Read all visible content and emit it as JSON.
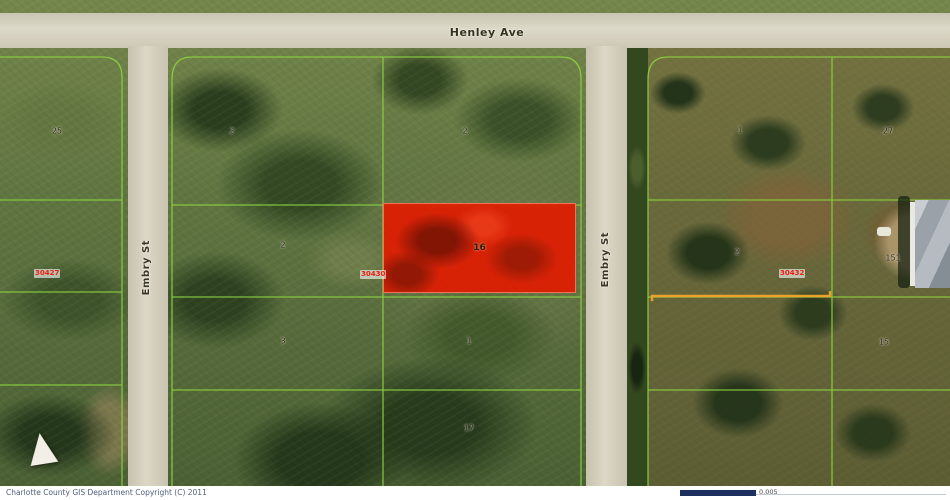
{
  "map": {
    "streets": {
      "top": {
        "label": "Henley Ave"
      },
      "left": {
        "label": "Embry St"
      },
      "right": {
        "label": "Embry St"
      }
    },
    "highlighted_parcel": {
      "number": "16"
    },
    "lot_id_labels": [
      {
        "text": "30427",
        "x": 34,
        "y": 269
      },
      {
        "text": "30430",
        "x": 360,
        "y": 270
      },
      {
        "text": "30432",
        "x": 779,
        "y": 269
      }
    ],
    "parcel_numbers": [
      {
        "text": "25",
        "x": 57,
        "y": 131
      },
      {
        "text": "2",
        "x": 232,
        "y": 131
      },
      {
        "text": "2",
        "x": 465,
        "y": 131
      },
      {
        "text": "1",
        "x": 740,
        "y": 130
      },
      {
        "text": "27",
        "x": 888,
        "y": 131
      },
      {
        "text": "2",
        "x": 283,
        "y": 245
      },
      {
        "text": "2",
        "x": 737,
        "y": 252
      },
      {
        "text": "151",
        "x": 893,
        "y": 258
      },
      {
        "text": "3",
        "x": 283,
        "y": 341
      },
      {
        "text": "1",
        "x": 469,
        "y": 341
      },
      {
        "text": "15",
        "x": 884,
        "y": 342
      },
      {
        "text": "17",
        "x": 469,
        "y": 428
      }
    ],
    "colors": {
      "parcel_line": "#8ccf3f",
      "highlight_fill": "#e01c02",
      "orange_boundary": "#f2a52a",
      "lot_label_text": "#ee2015",
      "road_fill": "#d6d1bf"
    }
  },
  "icons": {
    "north_arrow": "triangle-up"
  },
  "footer": {
    "copyright": "Charlotte County GIS Department Copyright (C) 2011",
    "scale_value": "0.005"
  }
}
